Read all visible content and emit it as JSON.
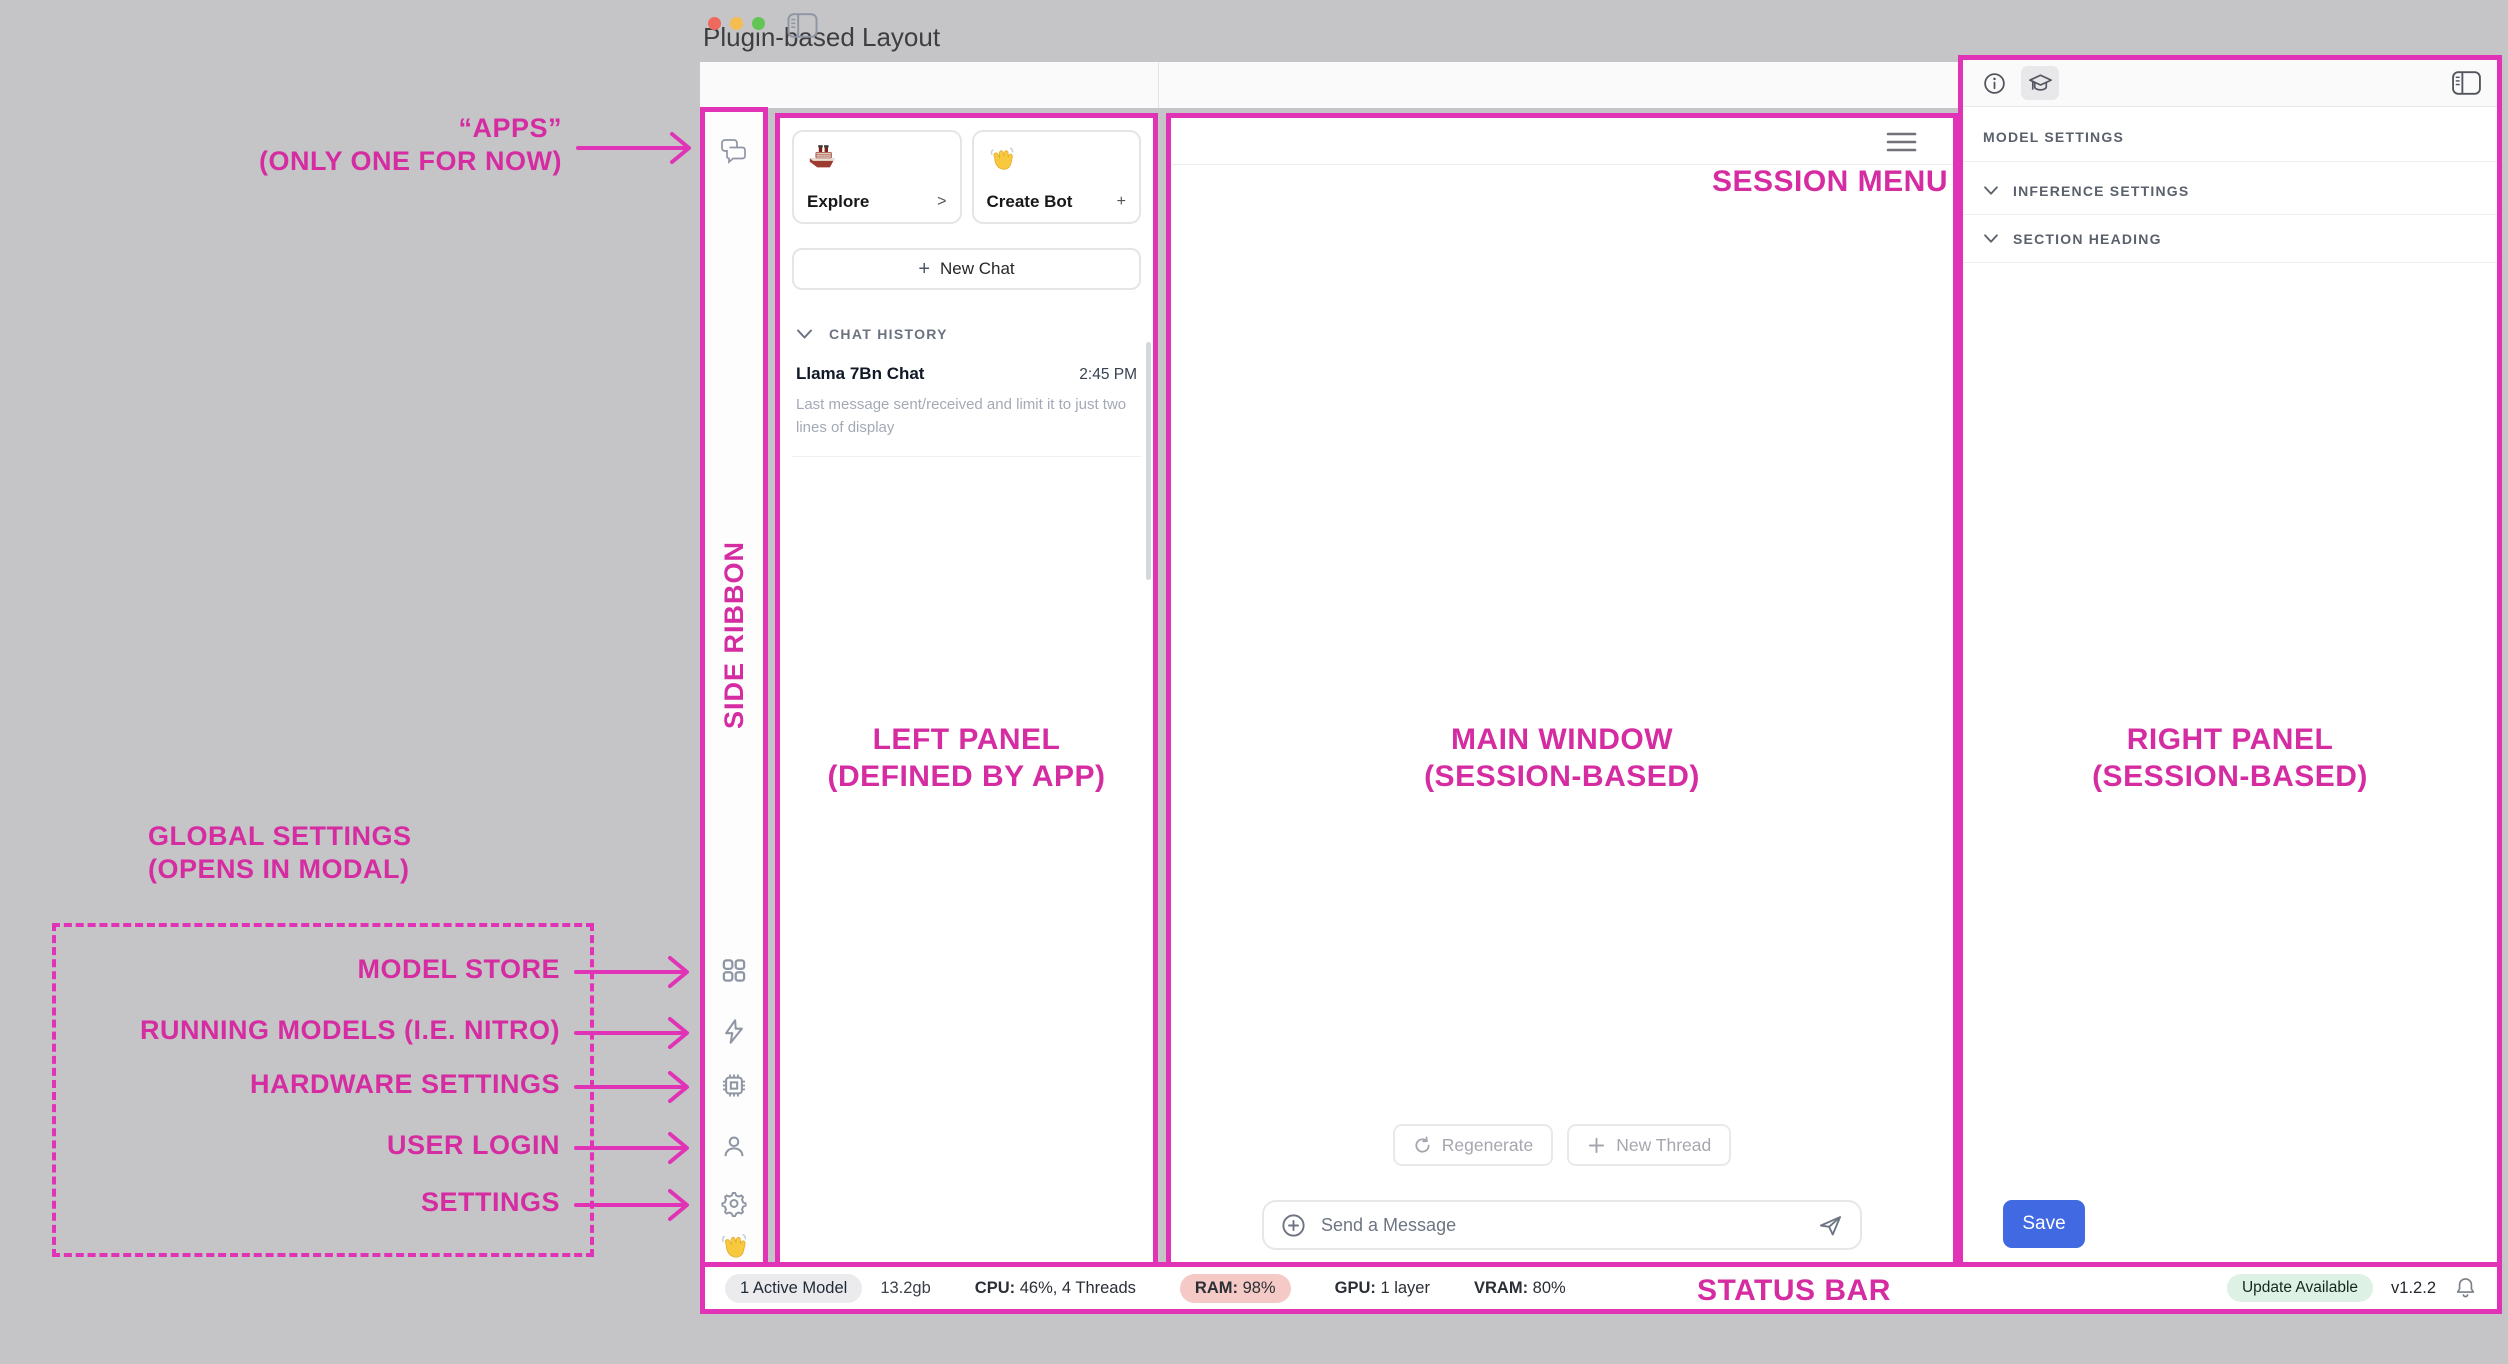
{
  "window_title": "Plugin-based Layout",
  "colors": {
    "annotation_magenta": "#E033B6",
    "save_button_blue": "#4169E1",
    "ram_badge_bg": "#F5C9C5",
    "update_badge_bg": "#DDF2E4",
    "active_model_badge_bg": "#EBEBED"
  },
  "annotations": {
    "apps_line1": "“APPS”",
    "apps_line2": "(ONLY ONE FOR NOW)",
    "side_ribbon": "SIDE RIBBON",
    "left_panel_line1": "LEFT PANEL",
    "left_panel_line2": "(DEFINED BY APP)",
    "main_window_line1": "MAIN WINDOW",
    "main_window_line2": "(SESSION-BASED)",
    "right_panel_line1": "RIGHT PANEL",
    "right_panel_line2": "(SESSION-BASED)",
    "session_menu": "SESSION MENU",
    "status_bar": "STATUS BAR",
    "global_settings_line1": "GLOBAL SETTINGS",
    "global_settings_line2": "(OPENS IN MODAL)",
    "global_items": [
      "MODEL STORE",
      "RUNNING MODELS (I.E. NITRO)",
      "HARDWARE SETTINGS",
      "USER LOGIN",
      "SETTINGS"
    ]
  },
  "left_panel": {
    "cards": [
      {
        "label": "Explore",
        "action": ">"
      },
      {
        "label": "Create Bot",
        "action": "+"
      }
    ],
    "new_chat_plus": "+",
    "new_chat_label": "New Chat",
    "chat_history_header": "CHAT HISTORY",
    "chat_item": {
      "title": "Llama 7Bn Chat",
      "time": "2:45 PM",
      "preview": "Last message sent/received and limit it to just two lines of display"
    }
  },
  "main_window": {
    "regenerate_label": "Regenerate",
    "new_thread_label": "New Thread",
    "message_placeholder": "Send a Message"
  },
  "right_panel": {
    "header": "MODEL SETTINGS",
    "sections": [
      "INFERENCE SETTINGS",
      "SECTION HEADING"
    ],
    "save_label": "Save"
  },
  "status_bar": {
    "active_model": "1 Active Model",
    "memory_size": "13.2gb",
    "cpu_label": "CPU:",
    "cpu_value": "46%, 4 Threads",
    "ram_label": "RAM:",
    "ram_value": "98%",
    "gpu_label": "GPU:",
    "gpu_value": "1 layer",
    "vram_label": "VRAM:",
    "vram_value": "80%",
    "update_badge": "Update Available",
    "version": "v1.2.2"
  }
}
